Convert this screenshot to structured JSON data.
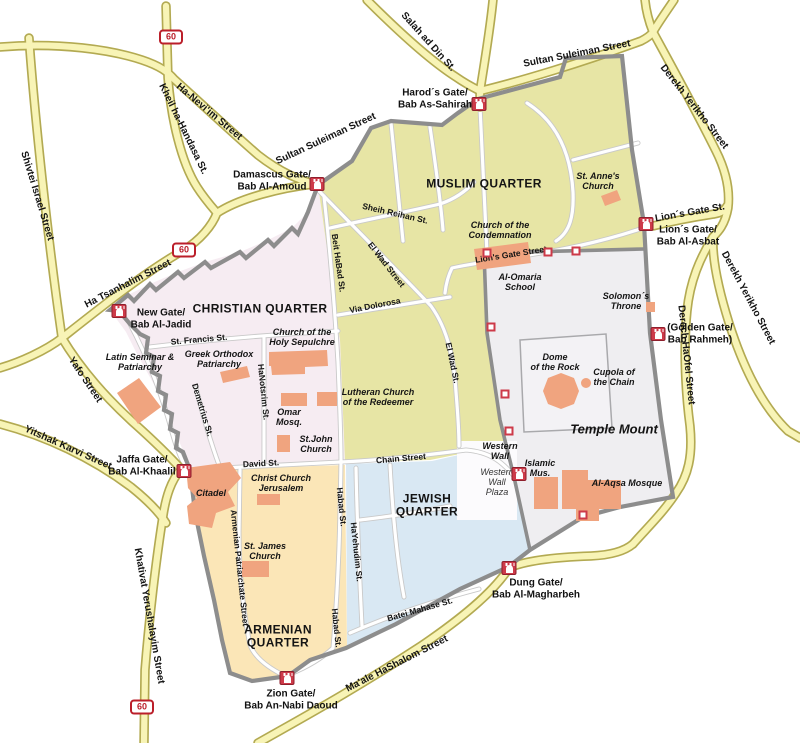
{
  "colors": {
    "muslim_quarter": "#e7e5a5",
    "christian_quarter": "#f6ecf2",
    "jewish_quarter": "#d9e8f3",
    "armenian_quarter": "#fbe6b7",
    "temple_mount": "#efeef1",
    "building": "#f0a47f",
    "road_fill": "#f8f4b6",
    "road_casing": "#b3aa52",
    "city_wall": "#8d8d8d",
    "gate_red": "#cd3a49",
    "shield_red": "#bb1f2a"
  },
  "map": {
    "labels": [
      {
        "name": "label-muslim-quarter",
        "kind": "quarter",
        "text": "MUSLIM QUARTER",
        "x": 484,
        "y": 184,
        "rot": 0
      },
      {
        "name": "label-christian-quarter",
        "kind": "quarter",
        "text": "CHRISTIAN QUARTER",
        "x": 260,
        "y": 309,
        "rot": 0
      },
      {
        "name": "label-jewish-quarter",
        "kind": "quarter",
        "text": "JEWISH\nQUARTER",
        "x": 427,
        "y": 506,
        "rot": 0
      },
      {
        "name": "label-armenian-quarter",
        "kind": "quarter",
        "text": "ARMENIAN\nQUARTER",
        "x": 278,
        "y": 637,
        "rot": 0
      },
      {
        "name": "label-temple-mount",
        "kind": "tm-title",
        "text": "Temple Mount",
        "x": 614,
        "y": 430,
        "rot": 0
      },
      {
        "name": "label-st-annes-church",
        "kind": "site",
        "text": "St. Anne's\nChurch",
        "x": 598,
        "y": 181,
        "rot": 0
      },
      {
        "name": "label-church-of-the-condemnation",
        "kind": "site",
        "text": "Church of the\nCondemnation",
        "x": 500,
        "y": 230,
        "rot": 0
      },
      {
        "name": "label-al-omaria-school",
        "kind": "site",
        "text": "Al-Omaria\nSchool",
        "x": 520,
        "y": 282,
        "rot": 0
      },
      {
        "name": "label-solomons-throne",
        "kind": "site",
        "text": "Solomon´s\nThrone",
        "x": 626,
        "y": 301,
        "rot": 0
      },
      {
        "name": "label-dome-of-the-rock",
        "kind": "site",
        "text": "Dome\nof the Rock",
        "x": 555,
        "y": 362,
        "rot": 0
      },
      {
        "name": "label-cupola-of-the-chain",
        "kind": "site",
        "text": "Cupola of\nthe Chain",
        "x": 614,
        "y": 377,
        "rot": 0
      },
      {
        "name": "label-al-aqsa-mosque",
        "kind": "site",
        "text": "Al-Aqsa Mosque",
        "x": 627,
        "y": 483,
        "rot": 0
      },
      {
        "name": "label-islamic-museum",
        "kind": "site",
        "text": "Islamic\nMus.",
        "x": 540,
        "y": 468,
        "rot": 0
      },
      {
        "name": "label-western-wall",
        "kind": "site",
        "text": "Western\nWall",
        "x": 500,
        "y": 451,
        "rot": 0
      },
      {
        "name": "label-western-wall-plaza",
        "kind": "plaza",
        "text": "Western\nWall\nPlaza",
        "x": 497,
        "y": 482,
        "rot": 0
      },
      {
        "name": "label-holy-sepulchre",
        "kind": "site",
        "text": "Church of the\nHoly Sepulchre",
        "x": 302,
        "y": 337,
        "rot": 0
      },
      {
        "name": "label-greek-orthodox-patriarchy",
        "kind": "site",
        "text": "Greek Orthodox\nPatriarchy",
        "x": 219,
        "y": 359,
        "rot": 0
      },
      {
        "name": "label-latin-seminar",
        "kind": "site",
        "text": "Latin Seminar &\nPatriarchy",
        "x": 140,
        "y": 362,
        "rot": 0
      },
      {
        "name": "label-lutheran-church",
        "kind": "site",
        "text": "Lutheran Church\nof the Redeemer",
        "x": 378,
        "y": 397,
        "rot": 0
      },
      {
        "name": "label-omar-mosque",
        "kind": "site",
        "text": "Omar\nMosq.",
        "x": 289,
        "y": 417,
        "rot": 0
      },
      {
        "name": "label-st-john-church",
        "kind": "site",
        "text": "St.John\nChurch",
        "x": 316,
        "y": 444,
        "rot": 0
      },
      {
        "name": "label-christ-church",
        "kind": "site",
        "text": "Christ Church\nJerusalem",
        "x": 281,
        "y": 483,
        "rot": 0
      },
      {
        "name": "label-citadel",
        "kind": "site",
        "text": "Citadel",
        "x": 211,
        "y": 493,
        "rot": 0
      },
      {
        "name": "label-st-james-church",
        "kind": "site",
        "text": "St. James\nChurch",
        "x": 265,
        "y": 551,
        "rot": 0
      },
      {
        "name": "label-sultan-suleiman-west",
        "kind": "highway",
        "text": "Sultan Suleiman Street",
        "x": 326,
        "y": 139,
        "rot": -25
      },
      {
        "name": "label-sultan-suleiman-east",
        "kind": "highway",
        "text": "Sultan Suleiman Street",
        "x": 577,
        "y": 54,
        "rot": -11
      },
      {
        "name": "label-salah-ad-din",
        "kind": "highway",
        "text": "Salah ad Din St.",
        "x": 428,
        "y": 42,
        "rot": 48
      },
      {
        "name": "label-ha-neviim",
        "kind": "highway",
        "text": "Ha-Nevi'im Street",
        "x": 209,
        "y": 112,
        "rot": 40
      },
      {
        "name": "label-kheil-ha-handasa",
        "kind": "highway",
        "text": "Kheil ha-Handasa St.",
        "x": 183,
        "y": 129,
        "rot": 64
      },
      {
        "name": "label-shivtei-israel",
        "kind": "highway",
        "text": "Shivtei Israel Street",
        "x": 37,
        "y": 196,
        "rot": 73
      },
      {
        "name": "label-ha-tsanhalim",
        "kind": "highway",
        "text": "Ha Tsanhalim Street",
        "x": 128,
        "y": 284,
        "rot": -27
      },
      {
        "name": "label-yafo-street",
        "kind": "highway",
        "text": "Yafo Street",
        "x": 85,
        "y": 380,
        "rot": 56
      },
      {
        "name": "label-yitshak-karvi",
        "kind": "highway",
        "text": "Yitshak Karvi Street",
        "x": 68,
        "y": 448,
        "rot": 24
      },
      {
        "name": "label-khativat-yerushalayim",
        "kind": "highway",
        "text": "Khativat Yerushalayim Street",
        "x": 149,
        "y": 616,
        "rot": 80
      },
      {
        "name": "label-maale-hashalom",
        "kind": "highway",
        "text": "Ma'ale HaShalom Street",
        "x": 397,
        "y": 664,
        "rot": -27
      },
      {
        "name": "label-derekh-yerikho-north",
        "kind": "highway",
        "text": "Derekh Yerikho Street",
        "x": 694,
        "y": 107,
        "rot": 52
      },
      {
        "name": "label-derekh-yerikho-south",
        "kind": "highway",
        "text": "Derekh Yerikho Street",
        "x": 748,
        "y": 298,
        "rot": 62
      },
      {
        "name": "label-derech-haofel",
        "kind": "highway",
        "text": "Derech HaOfel Street",
        "x": 686,
        "y": 355,
        "rot": 84
      },
      {
        "name": "label-lions-gate-st-outer",
        "kind": "highway",
        "text": "Lion´s Gate St.",
        "x": 690,
        "y": 213,
        "rot": -10
      },
      {
        "name": "label-lions-gate-street",
        "kind": "street",
        "text": "Lion's Gate Street",
        "x": 511,
        "y": 255,
        "rot": -9
      },
      {
        "name": "label-sheih-reihan",
        "kind": "street",
        "text": "Sheih Reihan St.",
        "x": 395,
        "y": 214,
        "rot": 13
      },
      {
        "name": "label-el-wad-street",
        "kind": "street",
        "text": "El Wad Street",
        "x": 386,
        "y": 265,
        "rot": 52
      },
      {
        "name": "label-el-wad-st",
        "kind": "street",
        "text": "El Wad St.",
        "x": 452,
        "y": 363,
        "rot": 78
      },
      {
        "name": "label-via-dolorosa",
        "kind": "street",
        "text": "Via Dolorosa",
        "x": 375,
        "y": 306,
        "rot": -11
      },
      {
        "name": "label-beit-habad",
        "kind": "street",
        "text": "Beit HaBad St.",
        "x": 338,
        "y": 263,
        "rot": 82
      },
      {
        "name": "label-st-francis",
        "kind": "street",
        "text": "St. Francis St.",
        "x": 199,
        "y": 340,
        "rot": -5
      },
      {
        "name": "label-hanotsrim",
        "kind": "street",
        "text": "HaNotsrim St.",
        "x": 263,
        "y": 392,
        "rot": 84
      },
      {
        "name": "label-demetrius",
        "kind": "street",
        "text": "Demetrius St.",
        "x": 202,
        "y": 410,
        "rot": 73
      },
      {
        "name": "label-david-st",
        "kind": "street",
        "text": "David St.",
        "x": 261,
        "y": 464,
        "rot": -3
      },
      {
        "name": "label-chain-street",
        "kind": "street",
        "text": "Chain Street",
        "x": 401,
        "y": 459,
        "rot": -5
      },
      {
        "name": "label-habad-st-north",
        "kind": "street",
        "text": "Habad St.",
        "x": 341,
        "y": 507,
        "rot": 84
      },
      {
        "name": "label-habad-st-south",
        "kind": "street",
        "text": "Habad St.",
        "x": 336,
        "y": 628,
        "rot": 84
      },
      {
        "name": "label-hayehudim",
        "kind": "street",
        "text": "HaYehudim St.",
        "x": 356,
        "y": 552,
        "rot": 84
      },
      {
        "name": "label-armenian-patriarchate",
        "kind": "street",
        "text": "Armenian Patriarchate Street",
        "x": 239,
        "y": 568,
        "rot": 84
      },
      {
        "name": "label-batei-mahase",
        "kind": "street",
        "text": "Batei Mahase St.",
        "x": 420,
        "y": 610,
        "rot": -16
      }
    ],
    "gates": [
      {
        "name": "harods-gate",
        "label": "Harod´s Gate/\nBab As-Sahirah",
        "icon_x": 479,
        "icon_y": 104,
        "label_x": 435,
        "label_y": 99
      },
      {
        "name": "damascus-gate",
        "label": "Damascus Gate/\nBab Al-Amoud",
        "icon_x": 317,
        "icon_y": 184,
        "label_x": 272,
        "label_y": 181
      },
      {
        "name": "lions-gate",
        "label": "Lion´s Gate/\nBab Al-Asbat",
        "icon_x": 646,
        "icon_y": 224,
        "label_x": 688,
        "label_y": 236
      },
      {
        "name": "golden-gate",
        "label": "(Golden Gate/\nBab Rahmeh)",
        "icon_x": 658,
        "icon_y": 334,
        "label_x": 700,
        "label_y": 334
      },
      {
        "name": "new-gate",
        "label": "New Gate/\nBab Al-Jadid",
        "icon_x": 119,
        "icon_y": 311,
        "label_x": 161,
        "label_y": 319
      },
      {
        "name": "jaffa-gate",
        "label": "Jaffa Gate/\nBab Al-Khaalil",
        "icon_x": 184,
        "icon_y": 471,
        "label_x": 142,
        "label_y": 466
      },
      {
        "name": "zion-gate",
        "label": "Zion Gate/\nBab An-Nabi Daoud",
        "icon_x": 287,
        "icon_y": 678,
        "label_x": 291,
        "label_y": 700
      },
      {
        "name": "dung-gate",
        "label": "Dung Gate/\nBab Al-Magharbeh",
        "icon_x": 509,
        "icon_y": 568,
        "label_x": 536,
        "label_y": 589
      },
      {
        "name": "islamic-museum-gate",
        "label": "",
        "icon_x": 519,
        "icon_y": 474,
        "label_x": 0,
        "label_y": 0
      }
    ],
    "minor_gates": [
      {
        "x": 487,
        "y": 253
      },
      {
        "x": 548,
        "y": 252
      },
      {
        "x": 576,
        "y": 251
      },
      {
        "x": 491,
        "y": 327
      },
      {
        "x": 505,
        "y": 394
      },
      {
        "x": 509,
        "y": 431
      },
      {
        "x": 583,
        "y": 515
      }
    ],
    "route_shields": [
      {
        "text": "60",
        "x": 171,
        "y": 37
      },
      {
        "text": "60",
        "x": 184,
        "y": 250
      },
      {
        "text": "60",
        "x": 142,
        "y": 707
      }
    ]
  }
}
